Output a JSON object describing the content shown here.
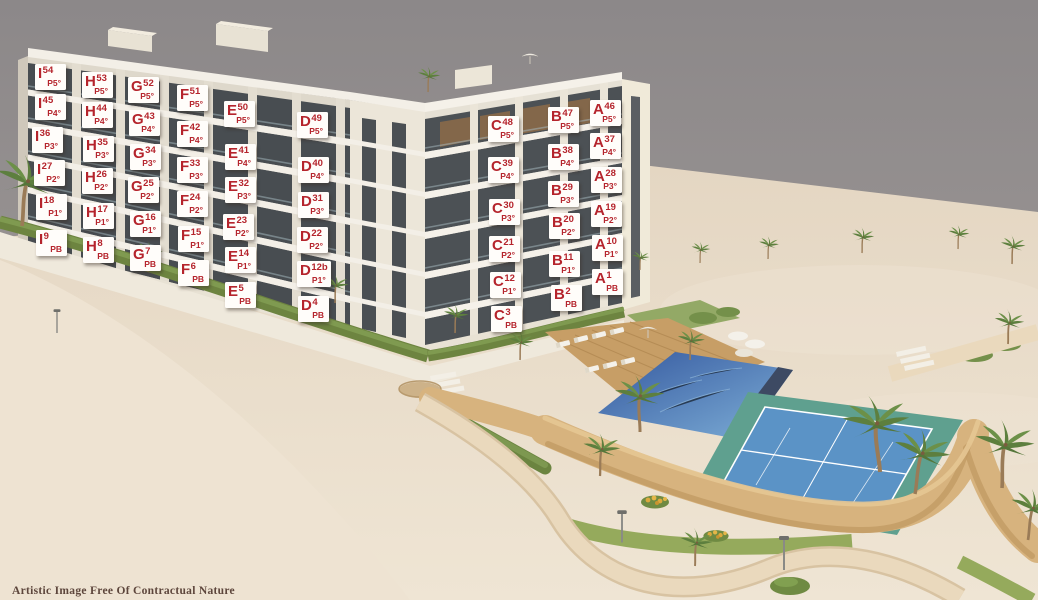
{
  "disclaimer": "Artistic Image Free Of Contractual Nature",
  "colors": {
    "label_background": "#fffdfa",
    "label_text_red": "#b5242c",
    "sky_gray": "#949091",
    "sand": "#e9dccb",
    "building_cream": "#e6e1d5",
    "window_dark": "#4a4f53",
    "hedge_green": "#6d8440",
    "pool_blue": "#3c63a8",
    "tennis_outer_teal": "#5fa08f",
    "tennis_inner_blue": "#5b93c6",
    "stone_wall_tan": "#d7b37e",
    "deck_wood": "#c79e66"
  },
  "blocks": [
    "I",
    "H",
    "G",
    "F",
    "E",
    "D",
    "C",
    "B",
    "A"
  ],
  "floors": [
    "PB",
    "P1°",
    "P2°",
    "P3°",
    "P4°",
    "P5°"
  ],
  "units": [
    {
      "block": "I",
      "number": "54",
      "floor": "P5°",
      "x": 35,
      "y": 64
    },
    {
      "block": "I",
      "number": "45",
      "floor": "P4°",
      "x": 35,
      "y": 94
    },
    {
      "block": "I",
      "number": "36",
      "floor": "P3°",
      "x": 32,
      "y": 127
    },
    {
      "block": "I",
      "number": "27",
      "floor": "P2°",
      "x": 34,
      "y": 160
    },
    {
      "block": "I",
      "number": "18",
      "floor": "P1°",
      "x": 36,
      "y": 194
    },
    {
      "block": "I",
      "number": "9",
      "floor": "PB",
      "x": 36,
      "y": 230
    },
    {
      "block": "H",
      "number": "53",
      "floor": "P5°",
      "x": 82,
      "y": 72
    },
    {
      "block": "H",
      "number": "44",
      "floor": "P4°",
      "x": 82,
      "y": 102
    },
    {
      "block": "H",
      "number": "35",
      "floor": "P3°",
      "x": 83,
      "y": 136
    },
    {
      "block": "H",
      "number": "26",
      "floor": "P2°",
      "x": 82,
      "y": 168
    },
    {
      "block": "H",
      "number": "17",
      "floor": "P1°",
      "x": 83,
      "y": 203
    },
    {
      "block": "H",
      "number": "8",
      "floor": "PB",
      "x": 83,
      "y": 237
    },
    {
      "block": "G",
      "number": "52",
      "floor": "P5°",
      "x": 128,
      "y": 77
    },
    {
      "block": "G",
      "number": "43",
      "floor": "P4°",
      "x": 129,
      "y": 110
    },
    {
      "block": "G",
      "number": "34",
      "floor": "P3°",
      "x": 130,
      "y": 144
    },
    {
      "block": "G",
      "number": "25",
      "floor": "P2°",
      "x": 128,
      "y": 177
    },
    {
      "block": "G",
      "number": "16",
      "floor": "P1°",
      "x": 130,
      "y": 211
    },
    {
      "block": "G",
      "number": "7",
      "floor": "PB",
      "x": 130,
      "y": 245
    },
    {
      "block": "F",
      "number": "51",
      "floor": "P5°",
      "x": 177,
      "y": 85
    },
    {
      "block": "F",
      "number": "42",
      "floor": "P4°",
      "x": 177,
      "y": 121
    },
    {
      "block": "F",
      "number": "33",
      "floor": "P3°",
      "x": 177,
      "y": 157
    },
    {
      "block": "F",
      "number": "24",
      "floor": "P2°",
      "x": 177,
      "y": 191
    },
    {
      "block": "F",
      "number": "15",
      "floor": "P1°",
      "x": 178,
      "y": 226
    },
    {
      "block": "F",
      "number": "6",
      "floor": "PB",
      "x": 178,
      "y": 260
    },
    {
      "block": "E",
      "number": "50",
      "floor": "P5°",
      "x": 224,
      "y": 101
    },
    {
      "block": "E",
      "number": "41",
      "floor": "P4°",
      "x": 225,
      "y": 144
    },
    {
      "block": "E",
      "number": "32",
      "floor": "P3°",
      "x": 225,
      "y": 177
    },
    {
      "block": "E",
      "number": "23",
      "floor": "P2°",
      "x": 223,
      "y": 214
    },
    {
      "block": "E",
      "number": "14",
      "floor": "P1°",
      "x": 225,
      "y": 247
    },
    {
      "block": "E",
      "number": "5",
      "floor": "PB",
      "x": 225,
      "y": 282
    },
    {
      "block": "D",
      "number": "49",
      "floor": "P5°",
      "x": 297,
      "y": 112
    },
    {
      "block": "D",
      "number": "40",
      "floor": "P4°",
      "x": 298,
      "y": 157
    },
    {
      "block": "D",
      "number": "31",
      "floor": "P3°",
      "x": 298,
      "y": 192
    },
    {
      "block": "D",
      "number": "22",
      "floor": "P2°",
      "x": 297,
      "y": 227
    },
    {
      "block": "D",
      "number": "12b",
      "floor": "P1°",
      "x": 297,
      "y": 261
    },
    {
      "block": "D",
      "number": "4",
      "floor": "PB",
      "x": 298,
      "y": 296
    },
    {
      "block": "C",
      "number": "48",
      "floor": "P5°",
      "x": 488,
      "y": 116
    },
    {
      "block": "C",
      "number": "39",
      "floor": "P4°",
      "x": 488,
      "y": 157
    },
    {
      "block": "C",
      "number": "30",
      "floor": "P3°",
      "x": 489,
      "y": 199
    },
    {
      "block": "C",
      "number": "21",
      "floor": "P2°",
      "x": 489,
      "y": 236
    },
    {
      "block": "C",
      "number": "12",
      "floor": "P1°",
      "x": 490,
      "y": 272
    },
    {
      "block": "C",
      "number": "3",
      "floor": "PB",
      "x": 491,
      "y": 306
    },
    {
      "block": "B",
      "number": "47",
      "floor": "P5°",
      "x": 548,
      "y": 107
    },
    {
      "block": "B",
      "number": "38",
      "floor": "P4°",
      "x": 548,
      "y": 144
    },
    {
      "block": "B",
      "number": "29",
      "floor": "P3°",
      "x": 548,
      "y": 181
    },
    {
      "block": "B",
      "number": "20",
      "floor": "P2°",
      "x": 549,
      "y": 213
    },
    {
      "block": "B",
      "number": "11",
      "floor": "P1°",
      "x": 549,
      "y": 251
    },
    {
      "block": "B",
      "number": "2",
      "floor": "PB",
      "x": 551,
      "y": 285
    },
    {
      "block": "A",
      "number": "46",
      "floor": "P5°",
      "x": 590,
      "y": 100
    },
    {
      "block": "A",
      "number": "37",
      "floor": "P4°",
      "x": 590,
      "y": 133
    },
    {
      "block": "A",
      "number": "28",
      "floor": "P3°",
      "x": 591,
      "y": 167
    },
    {
      "block": "A",
      "number": "19",
      "floor": "P2°",
      "x": 591,
      "y": 201
    },
    {
      "block": "A",
      "number": "10",
      "floor": "P1°",
      "x": 592,
      "y": 235
    },
    {
      "block": "A",
      "number": "1",
      "floor": "PB",
      "x": 592,
      "y": 269
    }
  ]
}
